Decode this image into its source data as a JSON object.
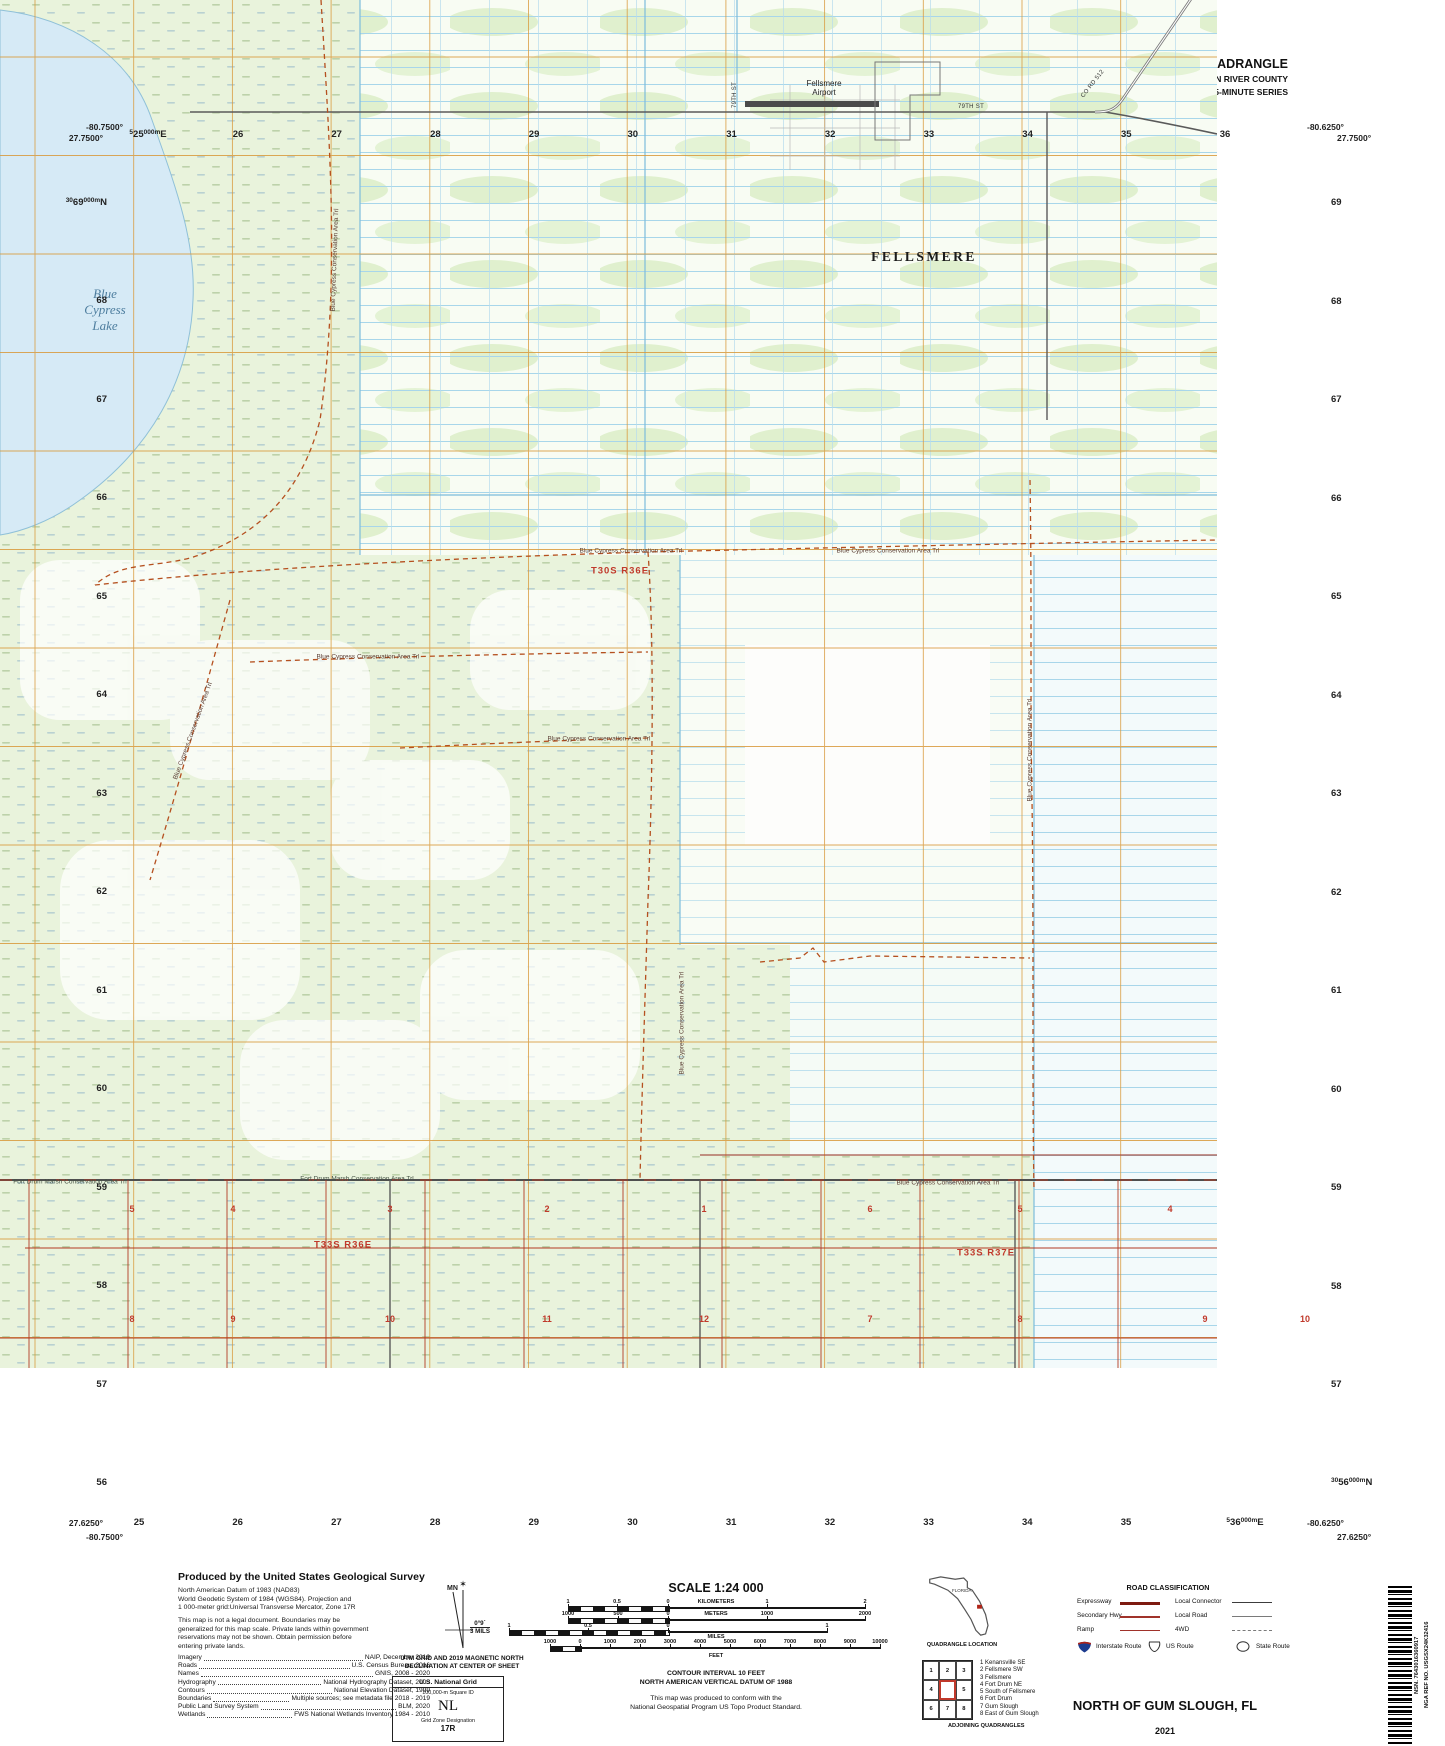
{
  "header": {
    "usgs_word": "USGS",
    "usgs_tagline": "science for a changing world",
    "dept_line1": "U.S. DEPARTMENT OF THE INTERIOR",
    "dept_line2": "U.S. GEOLOGICAL SURVEY",
    "tnm_name": "The National Map",
    "tnm_product": "US Topo",
    "quad_title": "NORTH OF GUM SLOUGH QUADRANGLE",
    "quad_subtitle1": "FLORIDA - INDIAN RIVER COUNTY",
    "quad_subtitle2": "7.5-MINUTE SERIES"
  },
  "map": {
    "corners": {
      "tl_lon": "-80.7500°",
      "tl_lat": "27.7500°",
      "tr_lon": "-80.6250°",
      "tr_lat": "27.7500°",
      "bl_lat": "27.6250°",
      "bl_lon": "-80.7500°",
      "br_lon": "-80.6250°",
      "br_lat": "27.6250°"
    },
    "margin": {
      "top_first": {
        "pre": "5",
        "num": "25",
        "suf": "000m",
        "unit": "E"
      },
      "bottom_last": {
        "pre": "5",
        "num": "36",
        "suf": "000m",
        "unit": "E"
      },
      "left_first": {
        "pre": "30",
        "num": "69",
        "suf": "000m",
        "unit": "N"
      },
      "right_last": {
        "pre": "30",
        "num": "56",
        "suf": "000m",
        "unit": "N"
      },
      "top_nums": [
        "26",
        "27",
        "28",
        "29",
        "30",
        "31",
        "32",
        "33",
        "34",
        "35",
        "36"
      ],
      "bottom_nums": [
        "25",
        "26",
        "27",
        "28",
        "29",
        "30",
        "31",
        "32",
        "33",
        "34",
        "35"
      ],
      "left_nums": [
        "68",
        "67",
        "66",
        "65",
        "64",
        "63",
        "62",
        "61",
        "60",
        "59",
        "58",
        "57",
        "56"
      ],
      "right_nums": [
        "69",
        "68",
        "67",
        "66",
        "65",
        "64",
        "63",
        "62",
        "61",
        "60",
        "59",
        "58",
        "57"
      ]
    },
    "labels": {
      "lake_lines": [
        "Blue",
        "Cypress",
        "Lake"
      ],
      "airport_lines": [
        "Fellsmere",
        "Airport"
      ],
      "city": "FELLSMERE",
      "st79": "79TH ST",
      "cord512": "CO RD 512",
      "trail": "Blue Cypress Conservation Area Trl",
      "fortdrum": "Fort Drum Marsh Conservation Area Trl",
      "twp_a": "T30S R36E",
      "twp_b": "T33S R36E",
      "twp_c": "T33S R37E"
    },
    "sections_row1": [
      {
        "n": "5",
        "x": 132
      },
      {
        "n": "4",
        "x": 233
      },
      {
        "n": "3",
        "x": 390
      },
      {
        "n": "2",
        "x": 547
      },
      {
        "n": "1",
        "x": 704
      },
      {
        "n": "6",
        "x": 870
      },
      {
        "n": "5",
        "x": 1020
      },
      {
        "n": "4",
        "x": 1170
      }
    ],
    "sections_row2": [
      {
        "n": "8",
        "x": 132
      },
      {
        "n": "9",
        "x": 233
      },
      {
        "n": "10",
        "x": 390
      },
      {
        "n": "11",
        "x": 547
      },
      {
        "n": "12",
        "x": 704
      },
      {
        "n": "7",
        "x": 870
      },
      {
        "n": "8",
        "x": 1020
      },
      {
        "n": "9",
        "x": 1205
      },
      {
        "n": "10",
        "x": 1305
      }
    ]
  },
  "footer": {
    "produced_by": "Produced by the United States Geological Survey",
    "datum": [
      "North American Datum of 1983 (NAD83)",
      "World Geodetic System of 1984 (WGS84).  Projection and",
      "1 000-meter grid:Universal Transverse Mercator, Zone 17R"
    ],
    "legal": [
      "This map is not a legal document. Boundaries may be",
      "generalized for this map scale. Private lands within government",
      "reservations may not be shown. Obtain permission before",
      "entering private lands."
    ],
    "sources": [
      {
        "l": "Imagery",
        "v": "NAIP, December 2019"
      },
      {
        "l": "Roads",
        "v": "U.S. Census Bureau, 2016"
      },
      {
        "l": "Names",
        "v": "GNIS, 2008 - 2020"
      },
      {
        "l": "Hydrography",
        "v": "National Hydrography Dataset, 2003"
      },
      {
        "l": "Contours",
        "v": "National Elevation Dataset, 1999"
      },
      {
        "l": "Boundaries",
        "v": "Multiple sources; see metadata file 2018 - 2019"
      },
      {
        "l": "Public Land Survey System",
        "v": "BLM, 2020"
      },
      {
        "l": "Wetlands",
        "v": "FWS National Wetlands Inventory 1984 - 2010"
      }
    ],
    "declination": {
      "mn": "MN",
      "star": "✶",
      "deg": "0°9´",
      "mils": "3 MILS",
      "cap1": "UTM GRID AND 2019 MAGNETIC NORTH",
      "cap2": "DECLINATION AT CENTER OF SHEET"
    },
    "usng": {
      "title": "U.S. National Grid",
      "sub": "100,000-m Square ID",
      "square": "NL",
      "zone_label": "Grid Zone Designation",
      "zone": "17R"
    },
    "scale_title": "SCALE 1:24 000",
    "bars": {
      "km": {
        "unit": "KILOMETERS",
        "labels": [
          "1",
          "0.5",
          "0",
          "1",
          "2"
        ]
      },
      "meters": {
        "unit": "METERS",
        "labels": [
          "1000",
          "500",
          "0",
          "1000",
          "2000"
        ]
      },
      "miles": {
        "unit": "MILES",
        "labels": [
          "1",
          "0.5",
          "0",
          "1"
        ]
      },
      "feet": {
        "unit": "FEET",
        "labels": [
          "1000",
          "0",
          "1000",
          "2000",
          "3000",
          "4000",
          "5000",
          "6000",
          "7000",
          "8000",
          "9000",
          "10000"
        ]
      }
    },
    "contour": [
      "CONTOUR INTERVAL 10 FEET",
      "NORTH AMERICAN VERTICAL DATUM OF 1988"
    ],
    "conform": [
      "This map was produced to conform with the",
      "National Geospatial Program US Topo Product Standard."
    ],
    "quad_location": {
      "state": "FLORIDA",
      "caption": "QUADRANGLE LOCATION"
    },
    "adjoining": {
      "nums": [
        "1",
        "2",
        "3",
        "4",
        "5",
        "6",
        "7",
        "8"
      ],
      "list": [
        "1 Kenansville SE",
        "2 Fellsmere SW",
        "3 Fellsmere",
        "4 Fort Drum NE",
        "5 South of Fellsmere",
        "6 Fort Drum",
        "7 Gum Slough",
        "8 East of Gum Slough"
      ],
      "caption": "ADJOINING QUADRANGLES"
    },
    "roads": {
      "title": "ROAD CLASSIFICATION",
      "left": [
        "Expressway",
        "Secondary Hwy",
        "Ramp"
      ],
      "right": [
        "Local Connector",
        "Local Road",
        "4WD"
      ],
      "shields": [
        "Interstate Route",
        "US Route",
        "State Route"
      ]
    },
    "map_name": "NORTH OF GUM SLOUGH,  FL",
    "year": "2021",
    "nsn": "NSN. 7643016360917",
    "nga": "NGA REF NO. USGSX24K32416"
  }
}
